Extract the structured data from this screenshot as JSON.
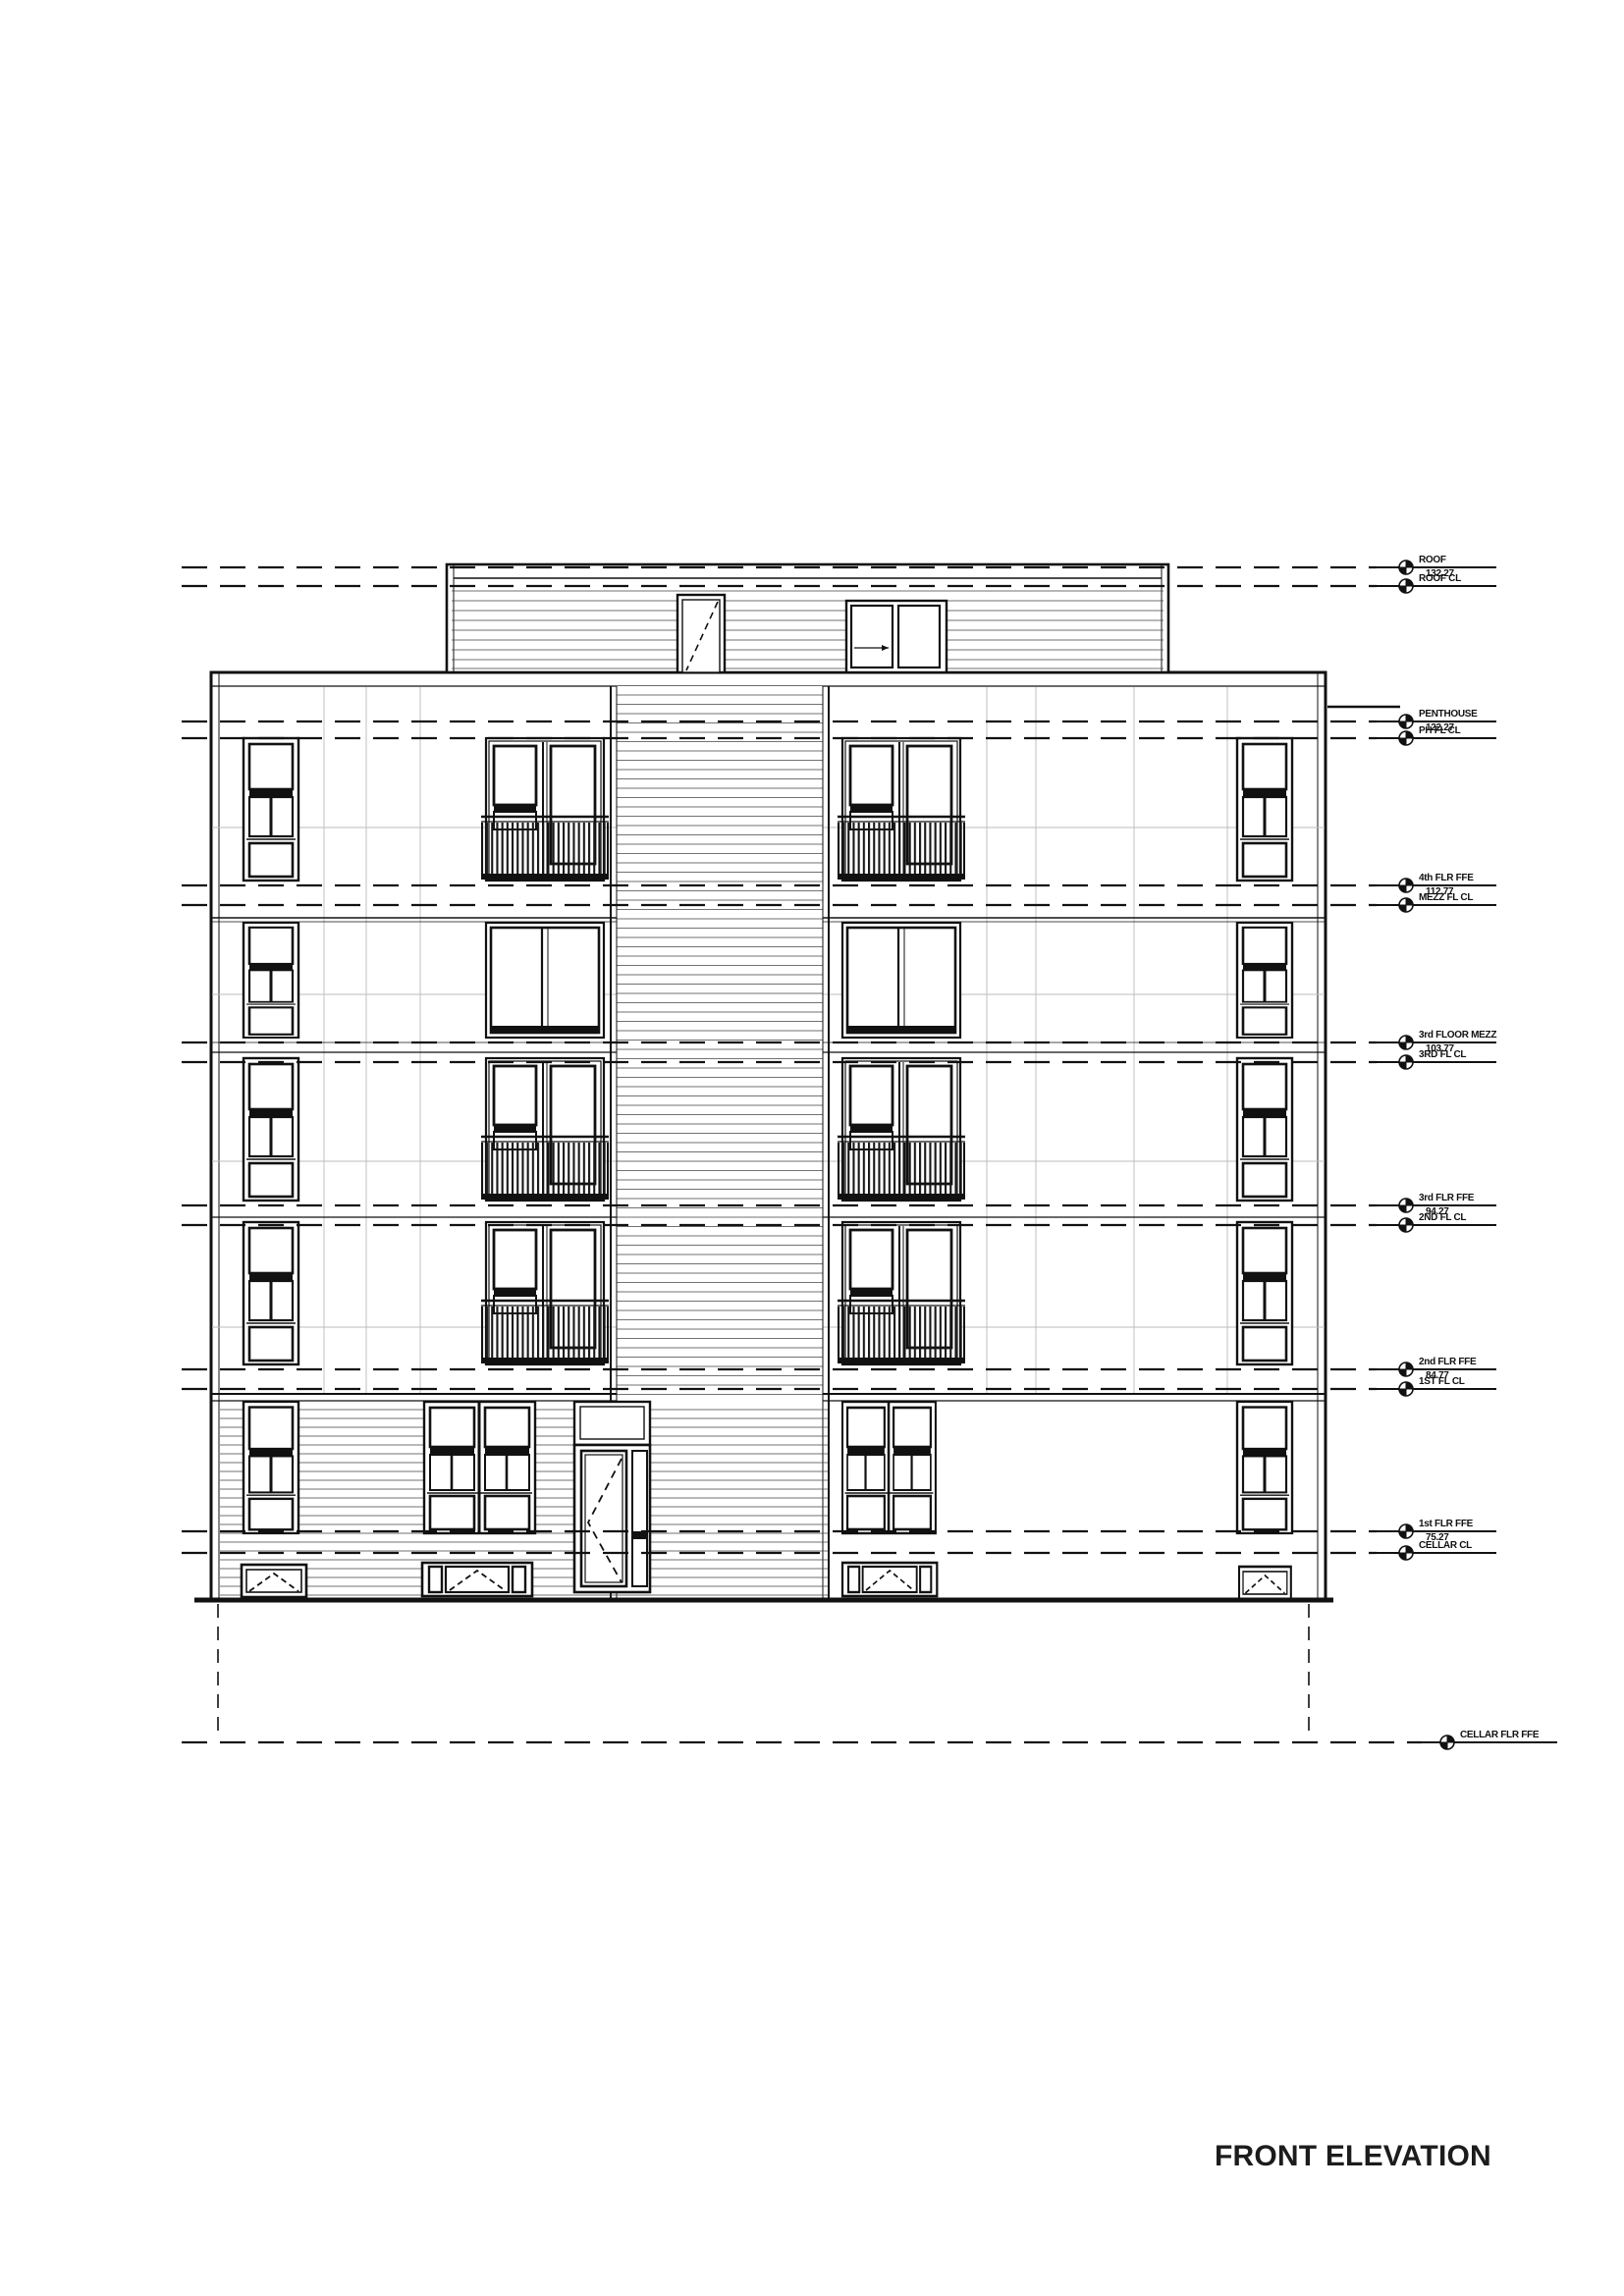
{
  "title": "FRONT ELEVATION",
  "drawing_type": "architectural-front-elevation",
  "colors": {
    "ink": "#111111",
    "siding": "#444444",
    "faint_grid": "#bbbbbb"
  },
  "levels": [
    {
      "name": "ROOF",
      "elevation": "132.27"
    },
    {
      "name": "ROOF CL"
    },
    {
      "name": "PENTHOUSE",
      "elevation": "122.27"
    },
    {
      "name": "PH FL CL"
    },
    {
      "name": "4th FLR FFE",
      "elevation": "112.77"
    },
    {
      "name": "MEZZ FL CL"
    },
    {
      "name": "3rd FLOOR MEZZ",
      "elevation": "103.77"
    },
    {
      "name": "3RD FL CL"
    },
    {
      "name": "3rd FLR FFE",
      "elevation": "94.27"
    },
    {
      "name": "2ND FL CL"
    },
    {
      "name": "2nd FLR FFE",
      "elevation": "84.77"
    },
    {
      "name": "1ST FL CL"
    },
    {
      "name": "1st FLR FFE",
      "elevation": "75.27"
    },
    {
      "name": "CELLAR CL"
    },
    {
      "name": "CELLAR FLR FFE"
    }
  ]
}
